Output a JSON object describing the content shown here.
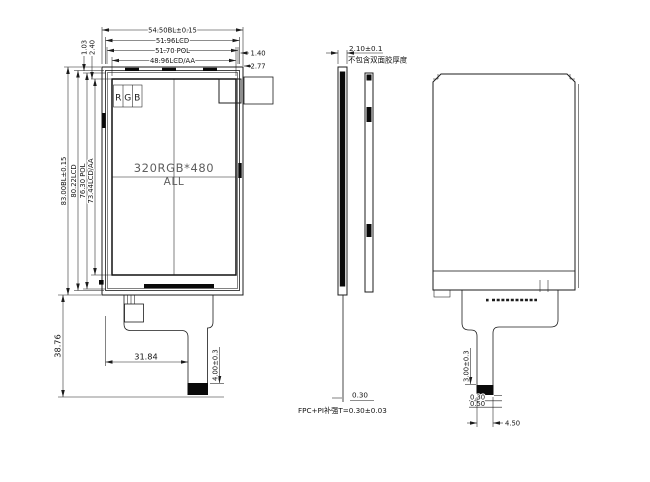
{
  "drawing": {
    "front": {
      "top_dims": [
        "54.50BL±0.15",
        "51.96LCD",
        "51.70 POL",
        "48.96LCD/AA"
      ],
      "top_right_offsets": [
        "1.40",
        "2.77"
      ],
      "left_dims": [
        "83.00BL±0.15",
        "80.22LCD",
        "76.30 POL",
        "73.44LCD/AA"
      ],
      "top_left_offsets": [
        "1.03",
        "2.40"
      ],
      "rgb_labels": [
        "R",
        "G",
        "B"
      ],
      "center_line1": "320RGB*480",
      "center_line2": "ALL",
      "fpc_height": "38.76",
      "fpc_width": "31.84",
      "connector_len": "4.00±0.3"
    },
    "side": {
      "thickness": "2.10±0.1",
      "thickness_note": "不包含双面胶厚度",
      "fpc_thickness": "0.30",
      "fpc_note": "FPC+PI补强T=0.30±0.03"
    },
    "back": {
      "stiffener_len": "3.00±0.3",
      "fpc_t": "0.30",
      "stiffener_t": "0.50",
      "connector_width": "4.50"
    },
    "colors": {
      "line": "#1c1c1c",
      "fill_black": "#0a0a0a",
      "background": "#ffffff"
    }
  }
}
